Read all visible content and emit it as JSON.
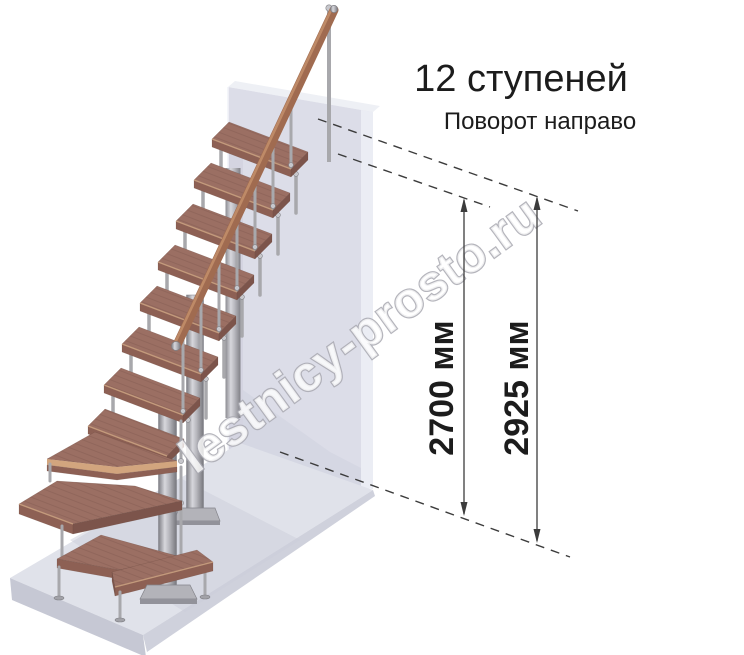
{
  "caption": {
    "title": "12 ступеней",
    "subtitle": "Поворот направо"
  },
  "dimensions": {
    "inner": {
      "label": "2700 мм"
    },
    "outer": {
      "label": "2925 мм"
    }
  },
  "watermark": "lestnicy-prosto.ru",
  "stairs": {
    "steps_total": 12,
    "straight_treads": 8,
    "winder_treads": 3,
    "bottom_treads": 1,
    "turn_direction": "направо"
  },
  "colors": {
    "text": "#1c1c1c",
    "line": "#3c3c3c",
    "wood_top": "#9b6f63",
    "wood_front": "#8d6054",
    "wood_side": "#7c544b",
    "wood_edge": "#c9a07f",
    "rail_wood": "#a06b50",
    "rail_light": "#c4906c",
    "metal": "#a8a8ac",
    "wall_front": "#dcdde8",
    "wall_top": "#eef0f5",
    "wall_highlight": "#ebedf4",
    "wall_shade": "#cfd0dd",
    "floor_top": "#e0e2ea",
    "floor_front": "#c6c8d4",
    "floor_side": "#cfd1dc",
    "watermark_fill": "#ffffff",
    "watermark_outline": "#a8a8b0"
  }
}
